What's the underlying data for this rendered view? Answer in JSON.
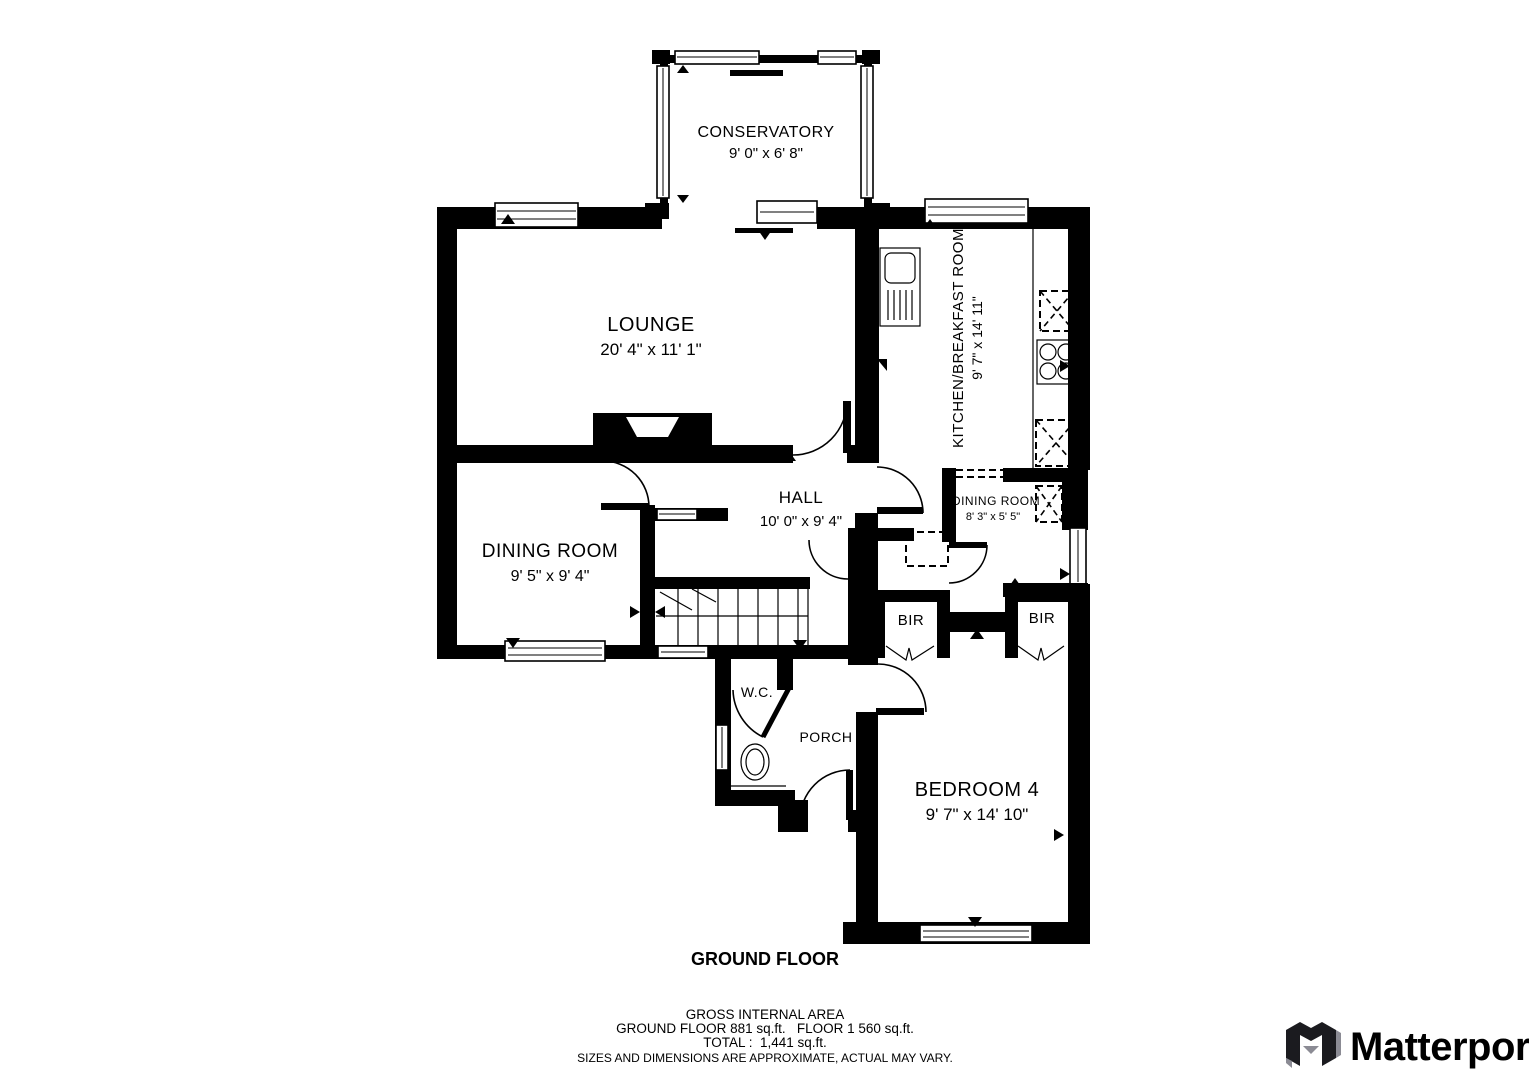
{
  "floorplan": {
    "floor_label": "GROUND FLOOR",
    "rooms": [
      {
        "id": "conservatory",
        "name": "CONSERVATORY",
        "dims": "9' 0\" x 6' 8\""
      },
      {
        "id": "lounge",
        "name": "LOUNGE",
        "dims": "20' 4\" x 11' 1\""
      },
      {
        "id": "kitchen",
        "name": "KITCHEN/BREAKFAST ROOM",
        "dims": "9' 7\" x 14' 11\""
      },
      {
        "id": "hall",
        "name": "HALL",
        "dims": "10' 0\" x 9' 4\""
      },
      {
        "id": "dining",
        "name": "DINING ROOM",
        "dims": "9' 5\" x 9' 4\""
      },
      {
        "id": "dining-nook",
        "name": "DINING ROOM",
        "dims": "8' 3\" x 5' 5\""
      },
      {
        "id": "bir-left",
        "name": "BIR",
        "dims": ""
      },
      {
        "id": "bir-right",
        "name": "BIR",
        "dims": ""
      },
      {
        "id": "wc",
        "name": "W.C.",
        "dims": ""
      },
      {
        "id": "porch",
        "name": "PORCH",
        "dims": ""
      },
      {
        "id": "bedroom4",
        "name": "BEDROOM 4",
        "dims": "9' 7\" x 14' 10\""
      }
    ],
    "footer": {
      "title": "GROSS INTERNAL AREA",
      "line1": "GROUND FLOOR 881 sq.ft.   FLOOR 1 560 sq.ft.",
      "total": "TOTAL :  1,441 sq.ft.",
      "disclaimer": "SIZES AND DIMENSIONS ARE APPROXIMATE, ACTUAL MAY VARY."
    },
    "brand": {
      "name": "Matterport"
    },
    "colors": {
      "wall": "#000000",
      "background": "#ffffff",
      "disclaimer_text": "#8f8f8f",
      "brand_text": "#36363e",
      "brand_gray": "#8b8b94"
    }
  }
}
